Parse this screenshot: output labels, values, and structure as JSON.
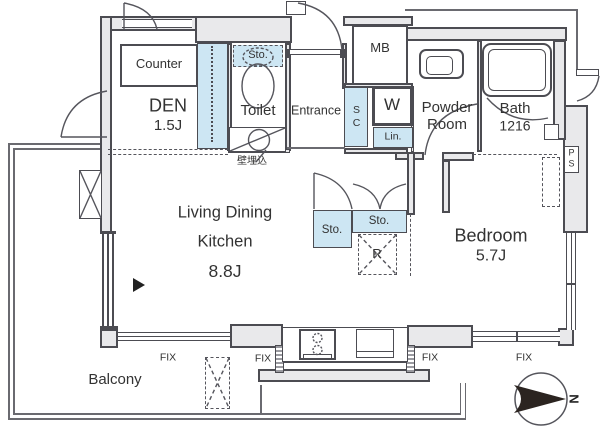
{
  "plan": {
    "rooms": {
      "den": {
        "name": "DEN",
        "size": "1.5J"
      },
      "toilet": {
        "name": "Toilet"
      },
      "entrance": {
        "name": "Entrance"
      },
      "powder_room": {
        "line1": "Powder",
        "line2": "Room"
      },
      "bath": {
        "name": "Bath",
        "size": "1216"
      },
      "ldk": {
        "line1": "Living Dining",
        "line2": "Kitchen",
        "size": "8.8J"
      },
      "bedroom": {
        "name": "Bedroom",
        "size": "5.7J"
      },
      "balcony": {
        "name": "Balcony"
      }
    },
    "fixtures": {
      "counter": "Counter",
      "meter_box": "MB",
      "shoe_closet": "SC",
      "washer": "W",
      "linen": "Lin.",
      "storage_toilet": "Sto.",
      "storage_hall_1": "Sto.",
      "storage_hall_2": "Sto.",
      "refrigerator": "R",
      "pipe_space_p": "P",
      "pipe_space_s": "S"
    },
    "annotations": {
      "wall_embedded": "壁埋込",
      "fix_1": "FIX",
      "fix_2": "FIX",
      "fix_3": "FIX",
      "fix_4": "FIX",
      "north": "N"
    },
    "colors": {
      "wall_line": "#4c4c52",
      "wall_fill": "#e9e9eb",
      "closet_fill": "#cde6f3",
      "compass_arrow": "#2b2420"
    }
  }
}
